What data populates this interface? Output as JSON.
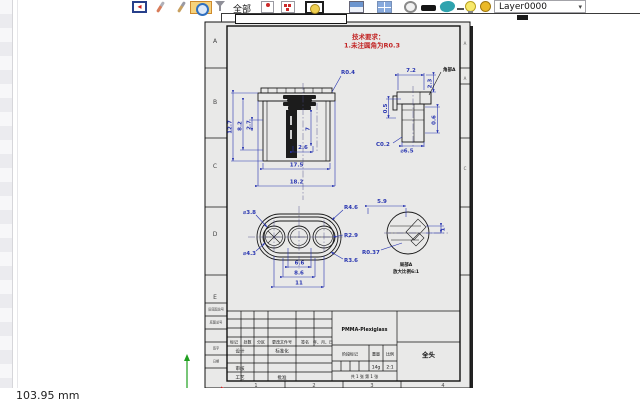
{
  "window": {
    "coordinate_readout": "103.95 mm"
  },
  "toolbar": {
    "filter_label": "全部",
    "layer": {
      "value": "Layer0000",
      "caret": "▾"
    },
    "icons": [
      "exit-icon",
      "brush-icon",
      "paint-brush-icon",
      "pan-globe-icon",
      "funnel-icon",
      "pin-icon",
      "stamp-icon",
      "framed-circle-icon",
      "window-icon",
      "grid-icon",
      "circle-icon",
      "black-bar-icon",
      "teal-solid-icon",
      "dash-icon",
      "bulb-icon",
      "sphere-icon",
      "layer-dropdown"
    ]
  },
  "colors": {
    "dimension_blue": "#2835b0",
    "note_red": "#c22525",
    "sheet_gray": "#e9e9e8",
    "highlight_orange": "#f6d27c"
  },
  "sheet": {
    "zones": {
      "letters": [
        "A",
        "B",
        "C",
        "D",
        "E"
      ],
      "numbers": [
        "1",
        "2",
        "3",
        "4"
      ]
    },
    "notes": {
      "title": "技术要求：",
      "line1": "1.未注圆角为R0.3"
    },
    "front_view": {
      "h_total": "12.7",
      "h_mid": "8.2",
      "h_top": "2.7",
      "h_inner": "7",
      "r_corner": "R0.4",
      "w_inner": "2.6",
      "w_mid": "17.5",
      "w_total": "18.2"
    },
    "section_view": {
      "w_top": "7.2",
      "h_rim": "2.3",
      "h_left": "0.5",
      "h_right": "0.6",
      "chamfer": "C0.2",
      "dia": "⌀6.5",
      "corner_label": "角部A"
    },
    "bottom_view": {
      "dia_small": "⌀3.8",
      "dia_big": "⌀4.3",
      "r_outer": "R4.6",
      "r_mid": "R2.9",
      "r_inner": "R3.6",
      "pitch": "6.6",
      "w_mid": "8.6",
      "w_total": "11"
    },
    "detail_view": {
      "w_top": "5.9",
      "h_right": "1",
      "r_groove": "R0.37",
      "label": "局部A",
      "scale_note": "放大比例6:1"
    },
    "title_block": {
      "material": "PMMA-Plexiglass",
      "part_name": "全头",
      "rev_headers": [
        "标记",
        "处数",
        "分区",
        "更改文件号",
        "签名",
        "年、月、日"
      ],
      "design": "设计",
      "standardize": "标准化",
      "check": "审核",
      "process": "工艺",
      "approve": "批准",
      "stage_label": "阶段标记",
      "weight_label": "重量",
      "scale_label": "比例",
      "weight_value": "14g",
      "scale_value": "2:1",
      "sheet_note": "共 1 张 第 1 张",
      "margin_labels": [
        "旧底图总号",
        "底图总号",
        "签字",
        "日期"
      ]
    }
  }
}
